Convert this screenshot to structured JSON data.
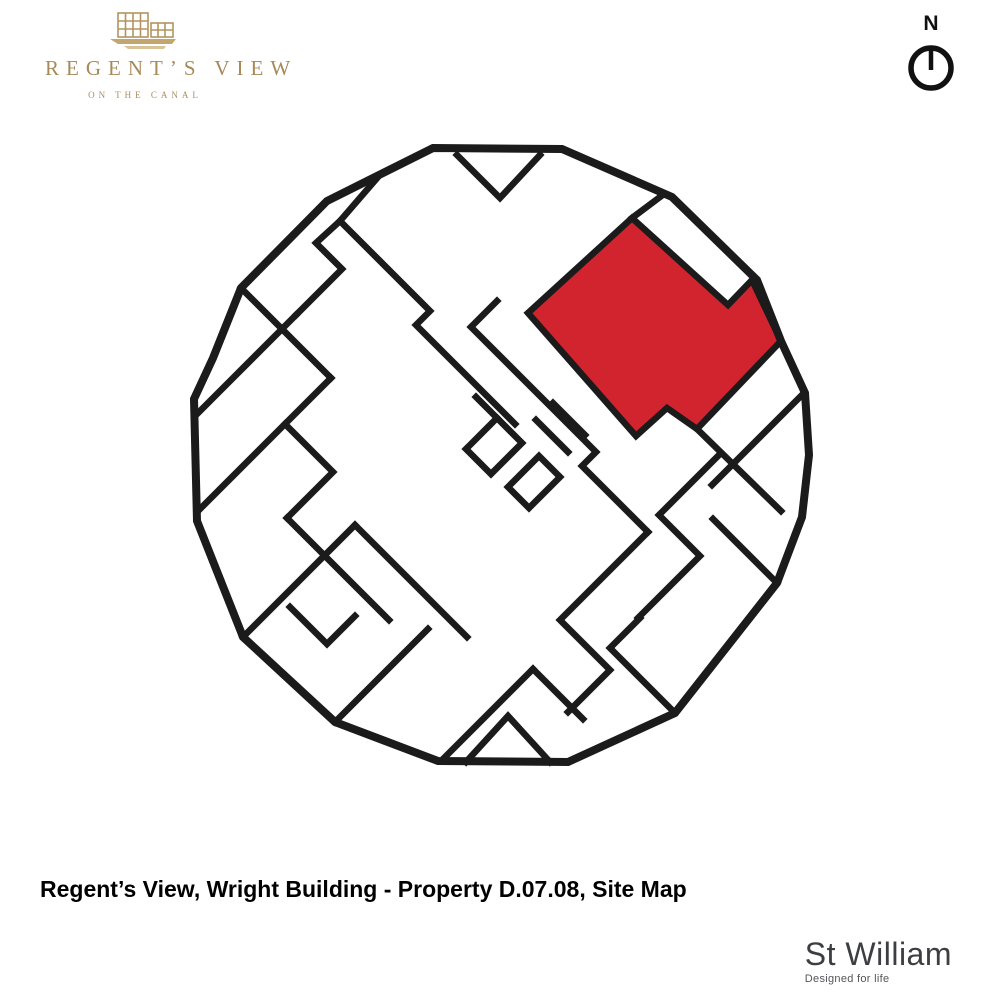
{
  "brand": {
    "name": "REGENT’S VIEW",
    "tagline": "ON THE CANAL",
    "text_color": "#a8895a",
    "icon_color": "#b3945f"
  },
  "compass": {
    "label": "N",
    "color": "#111111"
  },
  "caption": {
    "text": "Regent’s View, Wright Building - Property D.07.08, Site Map"
  },
  "developer": {
    "name": "St William",
    "tagline": "Designed for life"
  },
  "map": {
    "background": "#ffffff",
    "wall_color": "#1b1b1b",
    "highlight_color": "#d2242f",
    "outer_stroke_width": 8,
    "wall_stroke_width": 6.5,
    "outline_points": "433,148 562,149 672,197 757,280 781,341 805,393 809,455 802,517 777,583 675,713 568,762 438,761 335,722 243,637 197,521 194,399 213,358 241,288 327,201",
    "highlight_points": "632,218 728,305 752,280 781,341 697,429 667,408 636,436 528,313",
    "walls": [
      "457,155 500,198 540,155",
      "632,218 660,197",
      "378,177 340,221 316,243 342,269 296,315",
      "296,315 196,415",
      "340,221 430,311 416,325 515,424",
      "241,288 331,378",
      "331,378 285,424 333,472 287,518",
      "285,424 200,509",
      "287,518 389,620",
      "243,637 355,525",
      "355,525 467,637",
      "290,607 327,644 355,616",
      "497,301 471,327 596,452 582,466 648,532",
      "648,532 560,620 610,670 568,712",
      "697,429 781,511",
      "804,393 712,485",
      "721,453 659,515 700,556 638,618",
      "777,583 713,519",
      "675,713 610,648 640,618",
      "466,762 508,716 550,762",
      "445,757 533,669",
      "335,722 428,629",
      "533,669 583,719",
      "466,449 497,418 522,443 491,474 466,449",
      "508,487 539,456 560,477 529,508 508,487",
      "536,420 568,452",
      "553,403 585,435",
      "497,418 476,397"
    ]
  }
}
